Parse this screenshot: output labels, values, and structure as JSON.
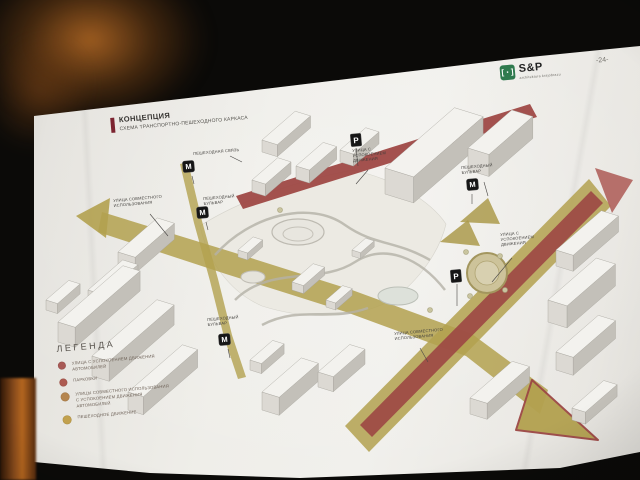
{
  "photo": {
    "page_number": "-24-"
  },
  "logo": {
    "name": "S&P",
    "tagline": "architektura krajobrazu",
    "icon": "green-square-bracket-logo",
    "color": "#2f7a4e"
  },
  "slide": {
    "title": "КОНЦЕПЦИЯ",
    "subtitle": "СХЕМА ТРАНСПОРТНО-ПЕШЕХОДНОГО КАРКАСА",
    "accent_color": "#7c2430"
  },
  "legend": {
    "heading": "ЛЕГЕНДА",
    "items": [
      {
        "label": "УЛИЦА С УСПОКОЕНИЕМ ДВИЖЕНИЯ\nАВТОМОБИЛЕЙ",
        "color": "#a85a56"
      },
      {
        "label": "ПАРКОВКИ",
        "color": "#ad5a50"
      },
      {
        "label": "УЛИЦЫ СОВМЕСТНОГО ИСПОЛЬЗОВАНИЯ\nС УСПОКОЕНИЕМ ДВИЖЕНИЯ\nАВТОМОБИЛЕЙ",
        "color": "#b5854e"
      },
      {
        "label": "ПЕШЕХОДНОЕ ДВИЖЕНИЕ",
        "color": "#c2a14e"
      }
    ]
  },
  "map": {
    "badges": {
      "metro": "М",
      "parking": "Р"
    },
    "labels": {
      "pedestrian_link": "ПЕШЕХОДНАЯ СВЯЗЬ",
      "shared_street_west": "УЛИЦА СОВМЕСТНОГО\nИСПОЛЬЗОВАНИЯ",
      "boulevard_nw": "ПЕШЕХОДНЫЙ\nБУЛЬВАР",
      "calmed_street_north": "УЛИЦА С\nУСПОКОЕНИЕМ\nДВИЖЕНИЯ",
      "boulevard_ne": "ПЕШЕХОДНЫЙ\nБУЛЬВАР",
      "calmed_street_east": "УЛИЦА С\nУСПОКОЕНИЕМ\nДВИЖЕНИЯ",
      "boulevard_sw": "ПЕШЕХОДНЫЙ\nБУЛЬВАР",
      "shared_street_south": "УЛИЦА СОВМЕСТНОГО\nИСПОЛЬЗОВАНИЯ"
    },
    "colors": {
      "pedestrian": "#b3a14f",
      "calmed_traffic": "#9c4744",
      "buildings": "#f3f2ee"
    }
  }
}
